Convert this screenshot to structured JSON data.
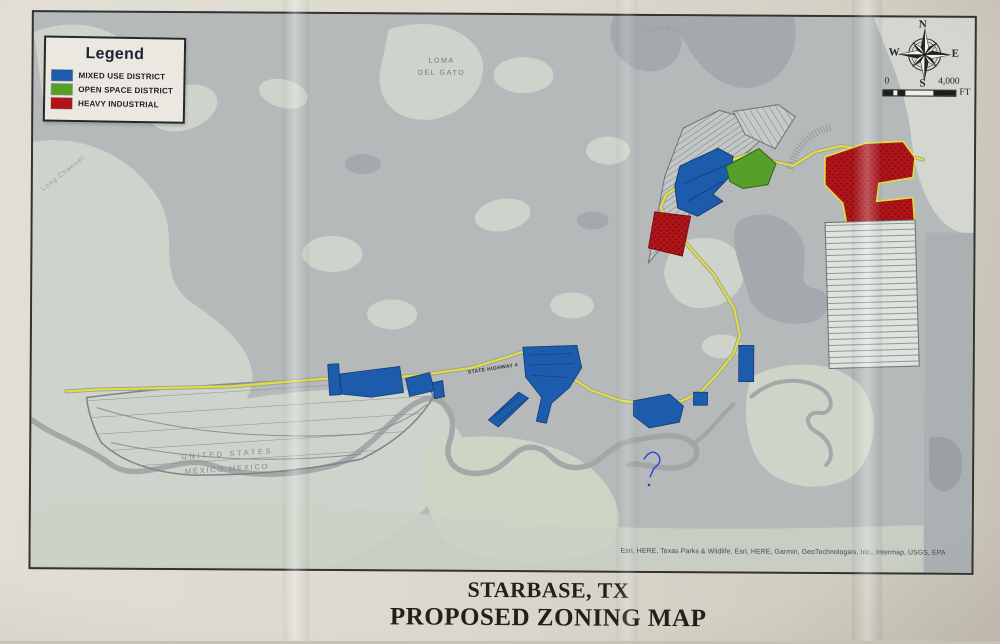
{
  "title": {
    "line1": "STARBASE, TX",
    "line2": "PROPOSED ZONING MAP"
  },
  "legend": {
    "title": "Legend",
    "items": [
      {
        "label": "MIXED USE DISTRICT",
        "color": "#1d5cad"
      },
      {
        "label": "OPEN SPACE DISTRICT",
        "color": "#55a029"
      },
      {
        "label": "HEAVY INDUSTRIAL",
        "color": "#b01419"
      }
    ]
  },
  "compass": {
    "north": "N",
    "east": "E",
    "south": "S",
    "west": "W"
  },
  "scale_bar": {
    "min": "0",
    "max": "4,000",
    "unit": "FT"
  },
  "map_labels": {
    "south_bay": "South Bay",
    "loma_del_gato_line1": "LOMA",
    "loma_del_gato_line2": "DEL GATO",
    "channel": "Long Channel",
    "highway": "STATE HIGHWAY 4",
    "border_line1": "UNITED STATES",
    "border_line2": "MÉXICO MEXICO"
  },
  "attribution": "Esri, HERE, Texas Parks & Wildlife, Esri, HERE, Garmin, GeoTechnologies, Inc., Intermap, USGS, EPA",
  "colors": {
    "mixed_use": "#1d5cad",
    "open_space": "#55a029",
    "heavy_industrial": "#b01419",
    "road_yellow": "#e3de3b",
    "water_gray": "#b5b9ba",
    "land_light": "#ced3cb"
  }
}
